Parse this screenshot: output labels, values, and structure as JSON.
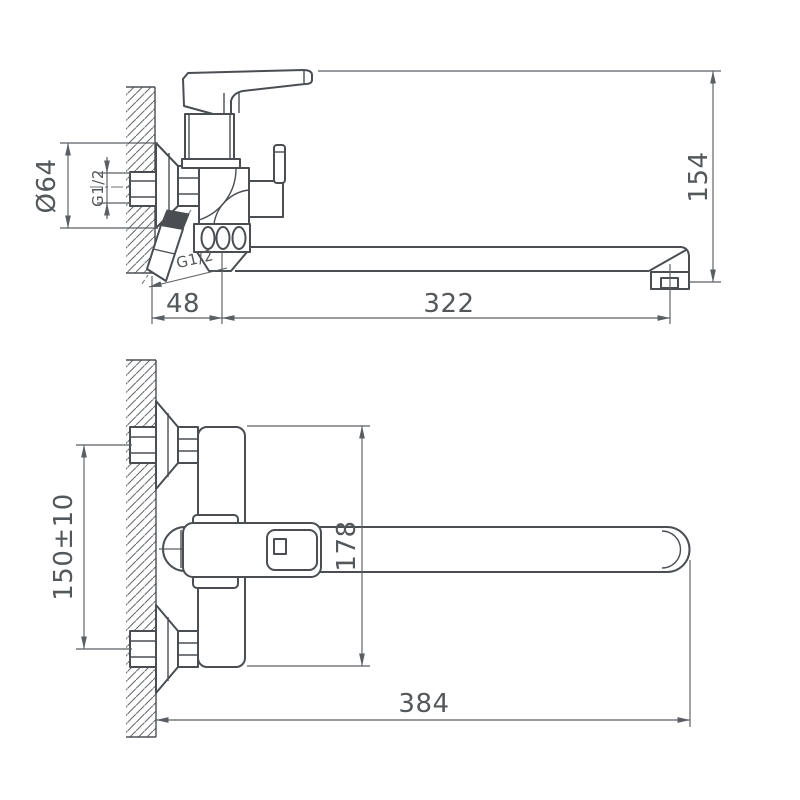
{
  "colors": {
    "background": "#ffffff",
    "line": "#4a4e53",
    "dimension_line": "#5b5f64",
    "text": "#54585a",
    "section_fill": "#4a4e53"
  },
  "labels": {
    "side_view": {
      "flange_diameter": "Ø64",
      "wall_inlet_thread": "G1/2",
      "shower_outlet_thread": "G1/2",
      "wall_to_spout_axis": "48",
      "spout_axis_to_outlet": "322",
      "handle_to_outlet_height": "154"
    },
    "front_view": {
      "inlet_spacing": "150±10",
      "body_length": "178",
      "wall_to_spout_end": "384"
    }
  }
}
